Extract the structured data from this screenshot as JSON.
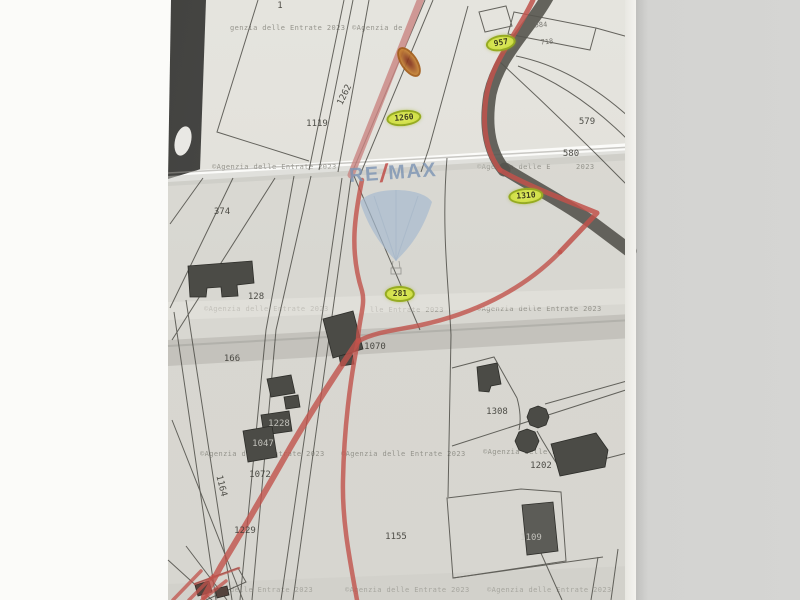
{
  "document": {
    "kind": "Scanned cadastral map photo with highlighted parcels"
  },
  "logo": {
    "re": "RE",
    "slash": "/",
    "max": "MAX"
  },
  "watermark": {
    "full": "©Agenzia delle Entrate 2023",
    "no_copyright": "genzia delle Entrate 2023",
    "start": "©Agenzia de",
    "mid": "lle Entrate 2023",
    "delle": "delle Entrate 2023",
    "agenzia_delle_e": "©Agenzia delle E",
    "year": "2023"
  },
  "highlighted_parcels": [
    {
      "value": "957"
    },
    {
      "value": "1260"
    },
    {
      "value": "1310"
    },
    {
      "value": "281"
    }
  ],
  "parcel_labels": [
    {
      "value": "1"
    },
    {
      "value": "374"
    },
    {
      "value": "1119"
    },
    {
      "value": "1262"
    },
    {
      "value": "584"
    },
    {
      "value": "718"
    },
    {
      "value": "579"
    },
    {
      "value": "580"
    },
    {
      "value": "128"
    },
    {
      "value": "166"
    },
    {
      "value": "1070"
    },
    {
      "value": "1308"
    },
    {
      "value": "1202"
    },
    {
      "value": "1228"
    },
    {
      "value": "1047"
    },
    {
      "value": "1072"
    },
    {
      "value": "1164"
    },
    {
      "value": "1229"
    },
    {
      "value": "1155"
    },
    {
      "value": "1109"
    }
  ],
  "colors": {
    "paper": "#d9d8d2",
    "paper_top": "#e2e1db",
    "background": "#d3d3d1",
    "boundary_red": "#c0524b",
    "road_pink": "#c98582",
    "highlight_yellow": "#c9d93c",
    "highlight_orange": "#cc8a35",
    "logo_blue": "#7e95b4",
    "logo_red": "#bf4a44",
    "line_dark": "#45443e"
  }
}
